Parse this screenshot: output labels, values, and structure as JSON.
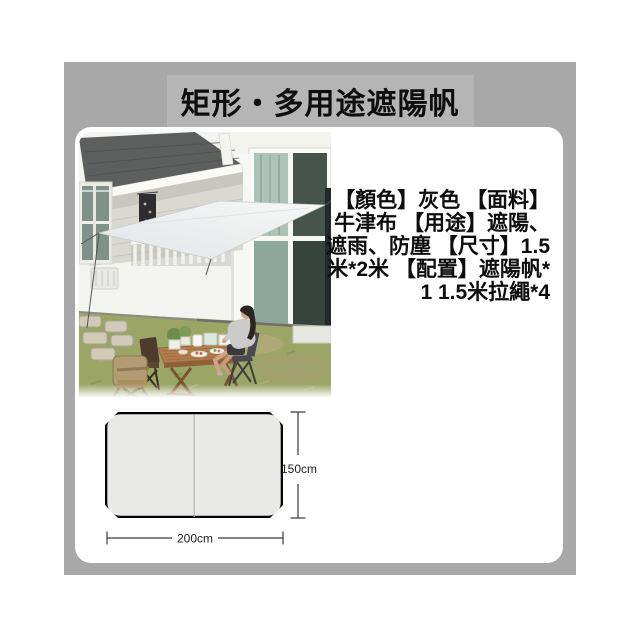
{
  "header": {
    "title": "矩形・多用途遮陽帆"
  },
  "product_info": {
    "lines": [
      "【顏色】灰色 【面料】",
      "牛津布 【用途】遮陽、",
      "遮雨、防塵 【尺寸】1.5",
      "米*2米 【配置】遮陽帆*",
      "1 1.5米拉繩*4"
    ],
    "full_text": "【顏色】灰色 【面料】牛津布 【用途】遮陽、遮雨、防塵 【尺寸】1.5米*2米 【配置】遮陽帆*1 1.5米拉繩*4"
  },
  "diagram": {
    "height_label": "150cm",
    "width_label": "200cm"
  },
  "colors": {
    "panel_background": "#a8a8a8",
    "title_highlight_background": "#b5b5b5",
    "card_background": "#ffffff",
    "diagram_tarp_fill": "#e9e9e7",
    "diagram_corner_color": "#000000"
  }
}
